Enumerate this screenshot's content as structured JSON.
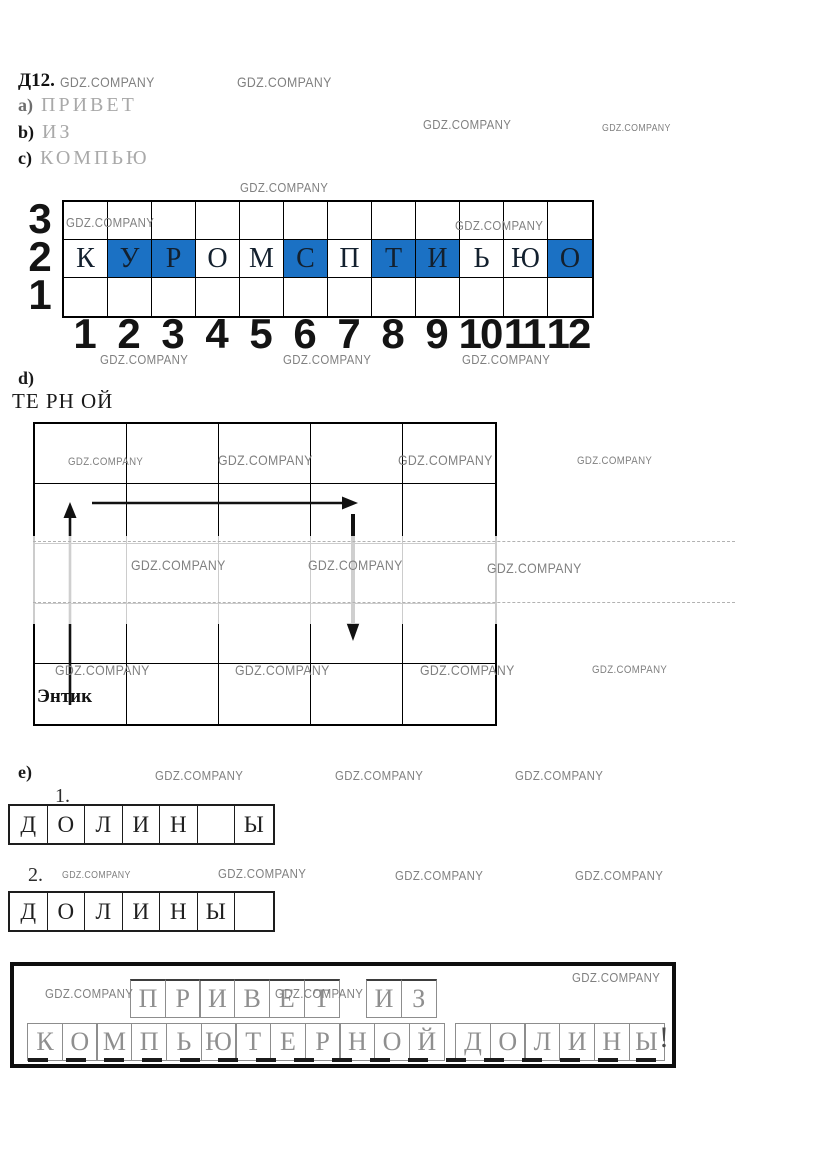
{
  "watermark": {
    "text": "GDZ.COMPANY",
    "color": "#808080",
    "positions": [
      [
        60,
        74,
        14
      ],
      [
        237,
        74,
        14
      ],
      [
        423,
        117,
        13
      ],
      [
        602,
        123,
        10
      ],
      [
        240,
        180,
        13
      ],
      [
        66,
        215,
        13
      ],
      [
        455,
        218,
        13
      ],
      [
        100,
        352,
        13
      ],
      [
        283,
        352,
        13
      ],
      [
        462,
        352,
        13
      ],
      [
        68,
        456,
        11
      ],
      [
        218,
        452,
        14
      ],
      [
        398,
        452,
        14
      ],
      [
        577,
        455,
        11
      ],
      [
        131,
        557,
        14
      ],
      [
        308,
        557,
        14
      ],
      [
        487,
        560,
        14
      ],
      [
        55,
        662,
        14
      ],
      [
        235,
        662,
        14
      ],
      [
        420,
        662,
        14
      ],
      [
        592,
        664,
        11
      ],
      [
        155,
        768,
        13
      ],
      [
        335,
        768,
        13
      ],
      [
        515,
        768,
        13
      ],
      [
        62,
        870,
        10
      ],
      [
        218,
        866,
        13
      ],
      [
        395,
        868,
        13
      ],
      [
        575,
        868,
        13
      ],
      [
        45,
        986,
        13
      ],
      [
        275,
        986,
        13
      ],
      [
        572,
        970,
        13
      ]
    ]
  },
  "header": {
    "task_number": "Д12.",
    "items": [
      {
        "marker": "a)",
        "word": "ПРИВЕТ"
      },
      {
        "marker": "b)",
        "word": "ИЗ"
      },
      {
        "marker": "c)",
        "word": "КОМПЬЮ"
      }
    ]
  },
  "coordinate_grid": {
    "row_labels": [
      "3",
      "2",
      "1"
    ],
    "col_labels": [
      "1",
      "2",
      "3",
      "4",
      "5",
      "6",
      "7",
      "8",
      "9",
      "10",
      "11",
      "12"
    ],
    "letters": [
      "К",
      "У",
      "Р",
      "О",
      "М",
      "С",
      "П",
      "Т",
      "И",
      "Ь",
      "Ю",
      "О"
    ],
    "highlighted": [
      false,
      true,
      true,
      false,
      false,
      true,
      false,
      true,
      true,
      false,
      false,
      true
    ],
    "highlight_color": "#1b71c4"
  },
  "section_d": {
    "marker": "d)",
    "answer_fragments": "ТЕ РН ОЙ",
    "caption": "Энтик",
    "grid": {
      "rows": 5,
      "cols": 5
    }
  },
  "section_e": {
    "marker": "e)",
    "rows": [
      {
        "label": "1.",
        "cells": [
          "Д",
          "О",
          "Л",
          "И",
          "Н",
          "",
          "Ы"
        ]
      },
      {
        "label": "2.",
        "cells": [
          "Д",
          "О",
          "Л",
          "И",
          "Н",
          "Ы",
          ""
        ]
      }
    ]
  },
  "answer_box": {
    "line1": [
      [
        "П",
        "Р",
        "И",
        "В",
        "Е",
        "Т"
      ],
      [
        "И",
        "З"
      ]
    ],
    "line2": [
      [
        "К",
        "О",
        "М",
        "П",
        "Ь",
        "Ю",
        "Т",
        "Е",
        "Р",
        "Н",
        "О",
        "Й"
      ],
      [
        "Д",
        "О",
        "Л",
        "И",
        "Н",
        "Ы"
      ]
    ],
    "suffix": "!"
  }
}
